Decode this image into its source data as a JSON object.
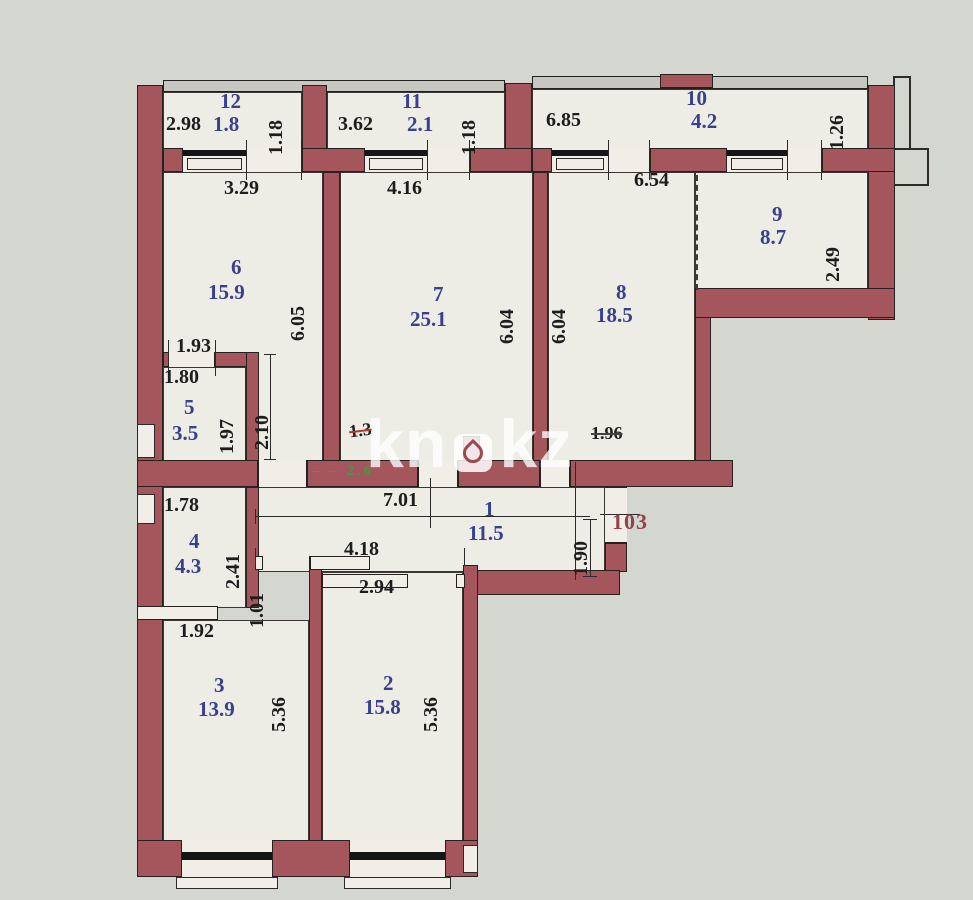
{
  "watermark": {
    "left": "kn",
    "right": "kz",
    "icon": "droplet-icon"
  },
  "apartment": {
    "number_label": "103"
  },
  "colors": {
    "bg": "#d4d7d0",
    "floor": "#edece5",
    "wall": "#a5565c",
    "blue": "#39408e",
    "red": "#93424c",
    "green": "#3f9b47"
  },
  "rooms": [
    {
      "number": "1",
      "area": "11.5"
    },
    {
      "number": "2",
      "area": "15.8"
    },
    {
      "number": "3",
      "area": "13.9"
    },
    {
      "number": "4",
      "area": "4.3"
    },
    {
      "number": "5",
      "area": "3.5"
    },
    {
      "number": "6",
      "area": "15.9"
    },
    {
      "number": "7",
      "area": "25.1"
    },
    {
      "number": "8",
      "area": "18.5"
    },
    {
      "number": "9",
      "area": "8.7"
    },
    {
      "number": "10",
      "area": "4.2"
    },
    {
      "number": "11",
      "area": "2.1"
    },
    {
      "number": "12",
      "area": "1.8"
    }
  ],
  "annotations": {
    "crossed_out": [
      "1.3",
      "1.96"
    ],
    "green_note": "‒ ‒ 2.6",
    "apartment_number": "103"
  },
  "labels": [
    {
      "id": "dim-2-98",
      "t": "2.98",
      "x": 166,
      "y": 114,
      "cls": "dim"
    },
    {
      "id": "room-12-no",
      "t": "12",
      "x": 220,
      "y": 91,
      "cls": "blue"
    },
    {
      "id": "room-12-area",
      "t": "1.8",
      "x": 213,
      "y": 114,
      "cls": "blue"
    },
    {
      "id": "dim-1-18-a",
      "t": "1.18",
      "x": 266,
      "y": 95,
      "cls": "dim",
      "rot": 1,
      "h": 60
    },
    {
      "id": "dim-3-62",
      "t": "3.62",
      "x": 338,
      "y": 114,
      "cls": "dim"
    },
    {
      "id": "room-11-no",
      "t": "11",
      "x": 402,
      "y": 91,
      "cls": "blue"
    },
    {
      "id": "room-11-area",
      "t": "2.1",
      "x": 407,
      "y": 114,
      "cls": "blue"
    },
    {
      "id": "dim-1-18-b",
      "t": "1.18",
      "x": 459,
      "y": 95,
      "cls": "dim",
      "rot": 1,
      "h": 60
    },
    {
      "id": "dim-6-85",
      "t": "6.85",
      "x": 546,
      "y": 110,
      "cls": "dim"
    },
    {
      "id": "room-10-no",
      "t": "10",
      "x": 686,
      "y": 88,
      "cls": "blue"
    },
    {
      "id": "room-10-area",
      "t": "4.2",
      "x": 691,
      "y": 111,
      "cls": "blue"
    },
    {
      "id": "dim-1-26",
      "t": "1.26",
      "x": 827,
      "y": 90,
      "cls": "dim",
      "rot": 1,
      "h": 60
    },
    {
      "id": "dim-3-29",
      "t": "3.29",
      "x": 224,
      "y": 178,
      "cls": "dim"
    },
    {
      "id": "dim-4-16",
      "t": "4.16",
      "x": 387,
      "y": 178,
      "cls": "dim"
    },
    {
      "id": "dim-6-54",
      "t": "6.54",
      "x": 634,
      "y": 170,
      "cls": "dim"
    },
    {
      "id": "room-6-no",
      "t": "6",
      "x": 231,
      "y": 257,
      "cls": "blue"
    },
    {
      "id": "room-6-area",
      "t": "15.9",
      "x": 208,
      "y": 282,
      "cls": "blue"
    },
    {
      "id": "dim-6-05",
      "t": "6.05",
      "x": 288,
      "y": 277,
      "cls": "dim",
      "rot": 1,
      "h": 64
    },
    {
      "id": "room-7-no",
      "t": "7",
      "x": 433,
      "y": 284,
      "cls": "blue"
    },
    {
      "id": "room-7-area",
      "t": "25.1",
      "x": 410,
      "y": 309,
      "cls": "blue"
    },
    {
      "id": "dim-6-04-a",
      "t": "6.04",
      "x": 497,
      "y": 280,
      "cls": "dim",
      "rot": 1,
      "h": 64
    },
    {
      "id": "dim-6-04-b",
      "t": "6.04",
      "x": 549,
      "y": 280,
      "cls": "dim",
      "rot": 1,
      "h": 64
    },
    {
      "id": "room-8-no",
      "t": "8",
      "x": 616,
      "y": 282,
      "cls": "blue"
    },
    {
      "id": "room-8-area",
      "t": "18.5",
      "x": 596,
      "y": 305,
      "cls": "blue"
    },
    {
      "id": "room-9-no",
      "t": "9",
      "x": 772,
      "y": 204,
      "cls": "blue"
    },
    {
      "id": "room-9-area",
      "t": "8.7",
      "x": 760,
      "y": 227,
      "cls": "blue"
    },
    {
      "id": "dim-2-49",
      "t": "2.49",
      "x": 823,
      "y": 218,
      "cls": "dim",
      "rot": 1,
      "h": 64
    },
    {
      "id": "dim-1-93",
      "t": "1.93",
      "x": 176,
      "y": 336,
      "cls": "dim"
    },
    {
      "id": "dim-1-80",
      "t": "1.80",
      "x": 164,
      "y": 367,
      "cls": "dim"
    },
    {
      "id": "room-5-no",
      "t": "5",
      "x": 184,
      "y": 397,
      "cls": "blue"
    },
    {
      "id": "room-5-area",
      "t": "3.5",
      "x": 172,
      "y": 423,
      "cls": "blue"
    },
    {
      "id": "dim-1-97",
      "t": "1.97",
      "x": 217,
      "y": 396,
      "cls": "dim",
      "rot": 1,
      "h": 58
    },
    {
      "id": "dim-2-10",
      "t": "2.10",
      "x": 252,
      "y": 388,
      "cls": "dim",
      "rot": 1,
      "h": 62
    },
    {
      "id": "note-1-3",
      "t": "1.3",
      "x": 349,
      "y": 421,
      "cls": "scrib scrib-red"
    },
    {
      "id": "note-green",
      "t": "‒ ‒ 2.6",
      "x": 312,
      "y": 464,
      "cls": "green"
    },
    {
      "id": "note-1-96",
      "t": "1.96",
      "x": 591,
      "y": 424,
      "cls": "scrib"
    },
    {
      "id": "dim-7-01",
      "t": "7.01",
      "x": 383,
      "y": 490,
      "cls": "dim"
    },
    {
      "id": "room-1-no",
      "t": "1",
      "x": 484,
      "y": 499,
      "cls": "blue"
    },
    {
      "id": "room-1-area",
      "t": "11.5",
      "x": 468,
      "y": 523,
      "cls": "blue"
    },
    {
      "id": "dim-1-90",
      "t": "1.90",
      "x": 571,
      "y": 514,
      "cls": "dim",
      "rot": 1,
      "h": 62
    },
    {
      "id": "apt-number",
      "t": "103",
      "x": 612,
      "y": 511,
      "cls": "apt"
    },
    {
      "id": "dim-1-78",
      "t": "1.78",
      "x": 164,
      "y": 495,
      "cls": "dim"
    },
    {
      "id": "room-4-no",
      "t": "4",
      "x": 189,
      "y": 531,
      "cls": "blue"
    },
    {
      "id": "room-4-area",
      "t": "4.3",
      "x": 175,
      "y": 556,
      "cls": "blue"
    },
    {
      "id": "dim-2-41",
      "t": "2.41",
      "x": 223,
      "y": 527,
      "cls": "dim",
      "rot": 1,
      "h": 62
    },
    {
      "id": "dim-1-01",
      "t": "1.01",
      "x": 247,
      "y": 572,
      "cls": "dim",
      "rot": 1,
      "h": 56
    },
    {
      "id": "dim-4-18",
      "t": "4.18",
      "x": 344,
      "y": 539,
      "cls": "dim"
    },
    {
      "id": "dim-2-94",
      "t": "2.94",
      "x": 359,
      "y": 577,
      "cls": "dim"
    },
    {
      "id": "dim-1-92",
      "t": "1.92",
      "x": 179,
      "y": 621,
      "cls": "dim"
    },
    {
      "id": "room-3-no",
      "t": "3",
      "x": 214,
      "y": 675,
      "cls": "blue"
    },
    {
      "id": "room-3-area",
      "t": "13.9",
      "x": 198,
      "y": 699,
      "cls": "blue"
    },
    {
      "id": "dim-5-36-a",
      "t": "5.36",
      "x": 269,
      "y": 668,
      "cls": "dim",
      "rot": 1,
      "h": 64
    },
    {
      "id": "room-2-no",
      "t": "2",
      "x": 383,
      "y": 673,
      "cls": "blue"
    },
    {
      "id": "room-2-area",
      "t": "15.8",
      "x": 364,
      "y": 697,
      "cls": "blue"
    },
    {
      "id": "dim-5-36-b",
      "t": "5.36",
      "x": 421,
      "y": 668,
      "cls": "dim",
      "rot": 1,
      "h": 64
    }
  ]
}
